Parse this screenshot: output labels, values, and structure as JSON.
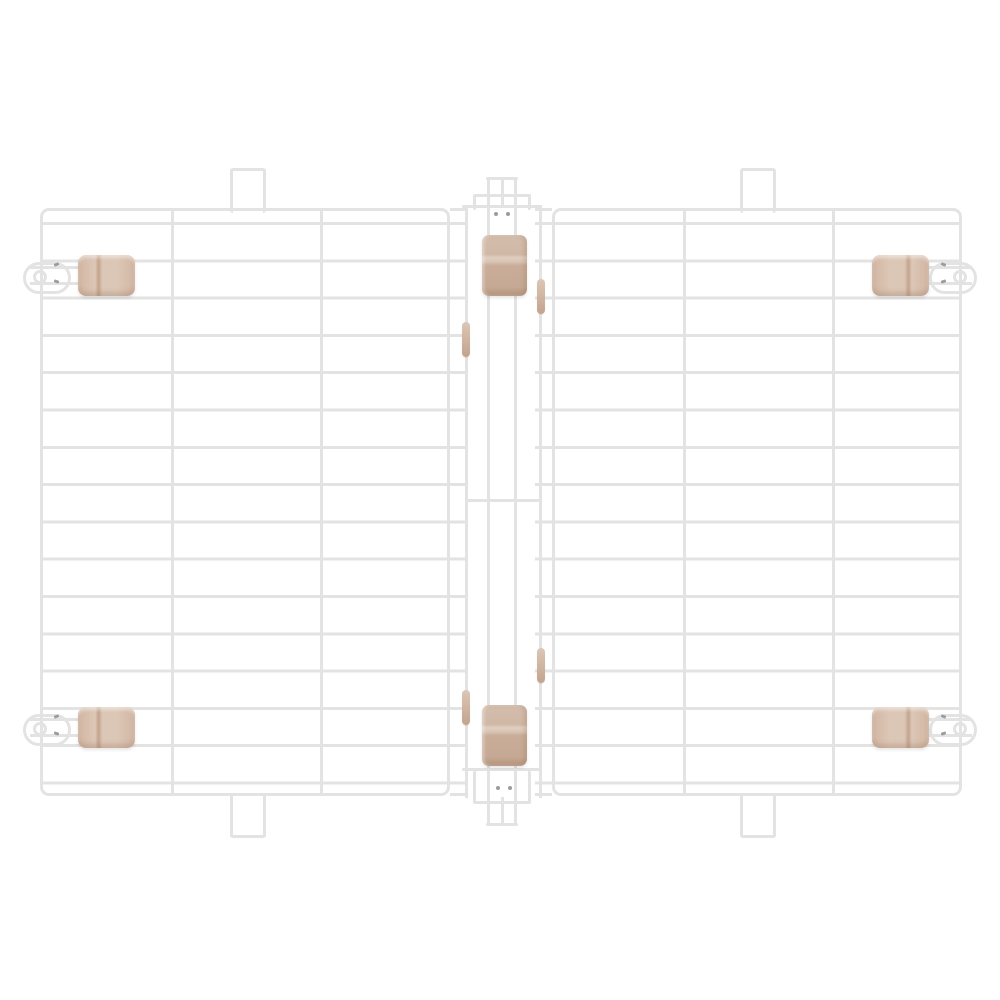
{
  "meta": {
    "type": "product-photo",
    "description": "Top-down product photo of a foldable white wire cage roof: two rectangular wire-grid panels joined by a central wire hinge, with beige plastic latch clips at the four outer corners, beige hinge clips at the top and bottom of the center rail, small beige sleeves on the hinge rails, and wire hanging tabs on the top and bottom edges.",
    "background_color": "#ffffff"
  },
  "colors": {
    "wire": "#e3e3e3",
    "wire_tip": "#9c9c9c",
    "clip_light": "#dcc7b6",
    "clip_mid": "#d2b6a3",
    "clip_band": "#c3a48d",
    "clip_dark": "#b49379"
  },
  "structure": {
    "panel_count": 2,
    "horizontal_wires_per_panel": 16,
    "columns_per_panel": 3,
    "corner_latch_clips": 4,
    "hinge_clips": 2,
    "rail_sleeves": 4,
    "hanging_tabs": 4,
    "hinge_has_center_crossbar": true
  }
}
